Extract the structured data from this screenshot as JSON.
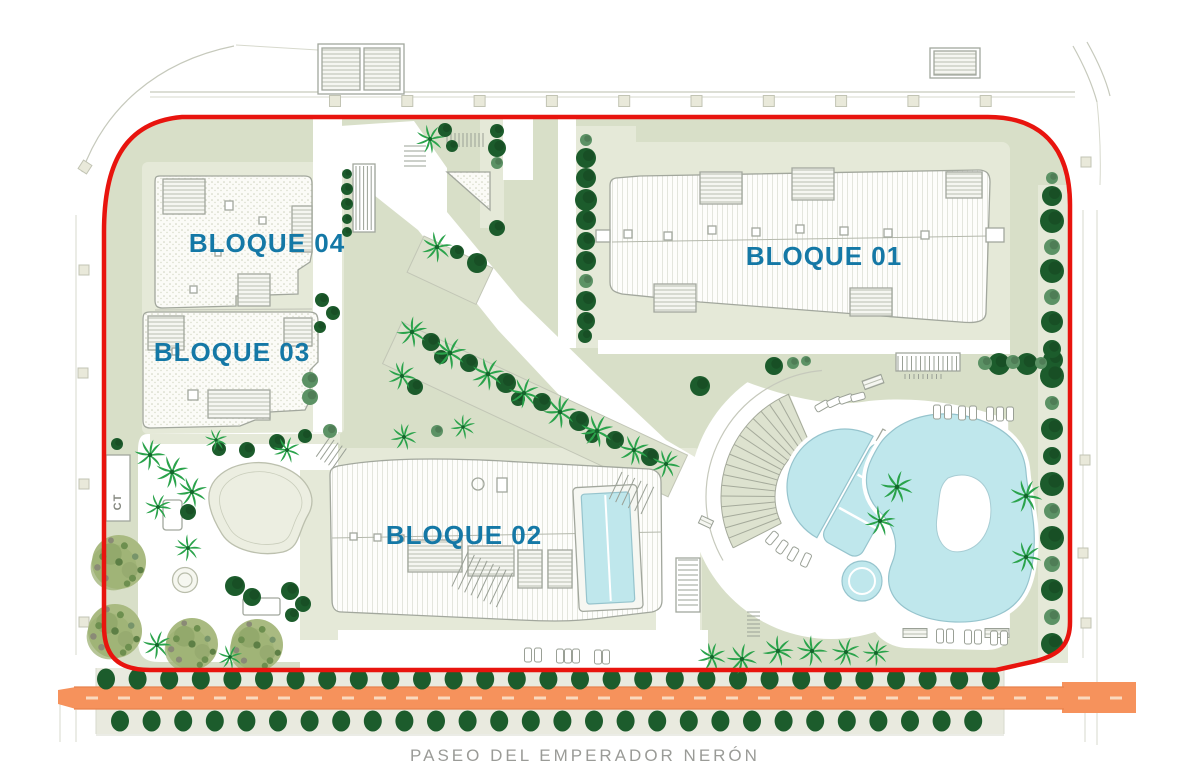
{
  "labels": {
    "block01": "BLOQUE 01",
    "block02": "BLOQUE 02",
    "block03": "BLOQUE 03",
    "block04": "BLOQUE 04",
    "utility": "CT",
    "street": "PASEO DEL EMPERADOR NERÓN"
  },
  "colors": {
    "boundary-red": "#e8140e",
    "label-blue": "#1478a6",
    "site-sage": "#d8dfc8",
    "pad-green": "#e5e9d8",
    "tree-dark": "#1c5c2c",
    "tree-mid": "#5c9265",
    "palm-green": "#2aa34b",
    "olive-green": "#a9ba81",
    "pool-blue": "#bfe7ec",
    "pool-edge": "#96c4cd",
    "road-orange": "#f6925c",
    "road-dash": "#fad9bf",
    "line-gray": "#c6c9bc",
    "street-text": "#9a9b97"
  }
}
